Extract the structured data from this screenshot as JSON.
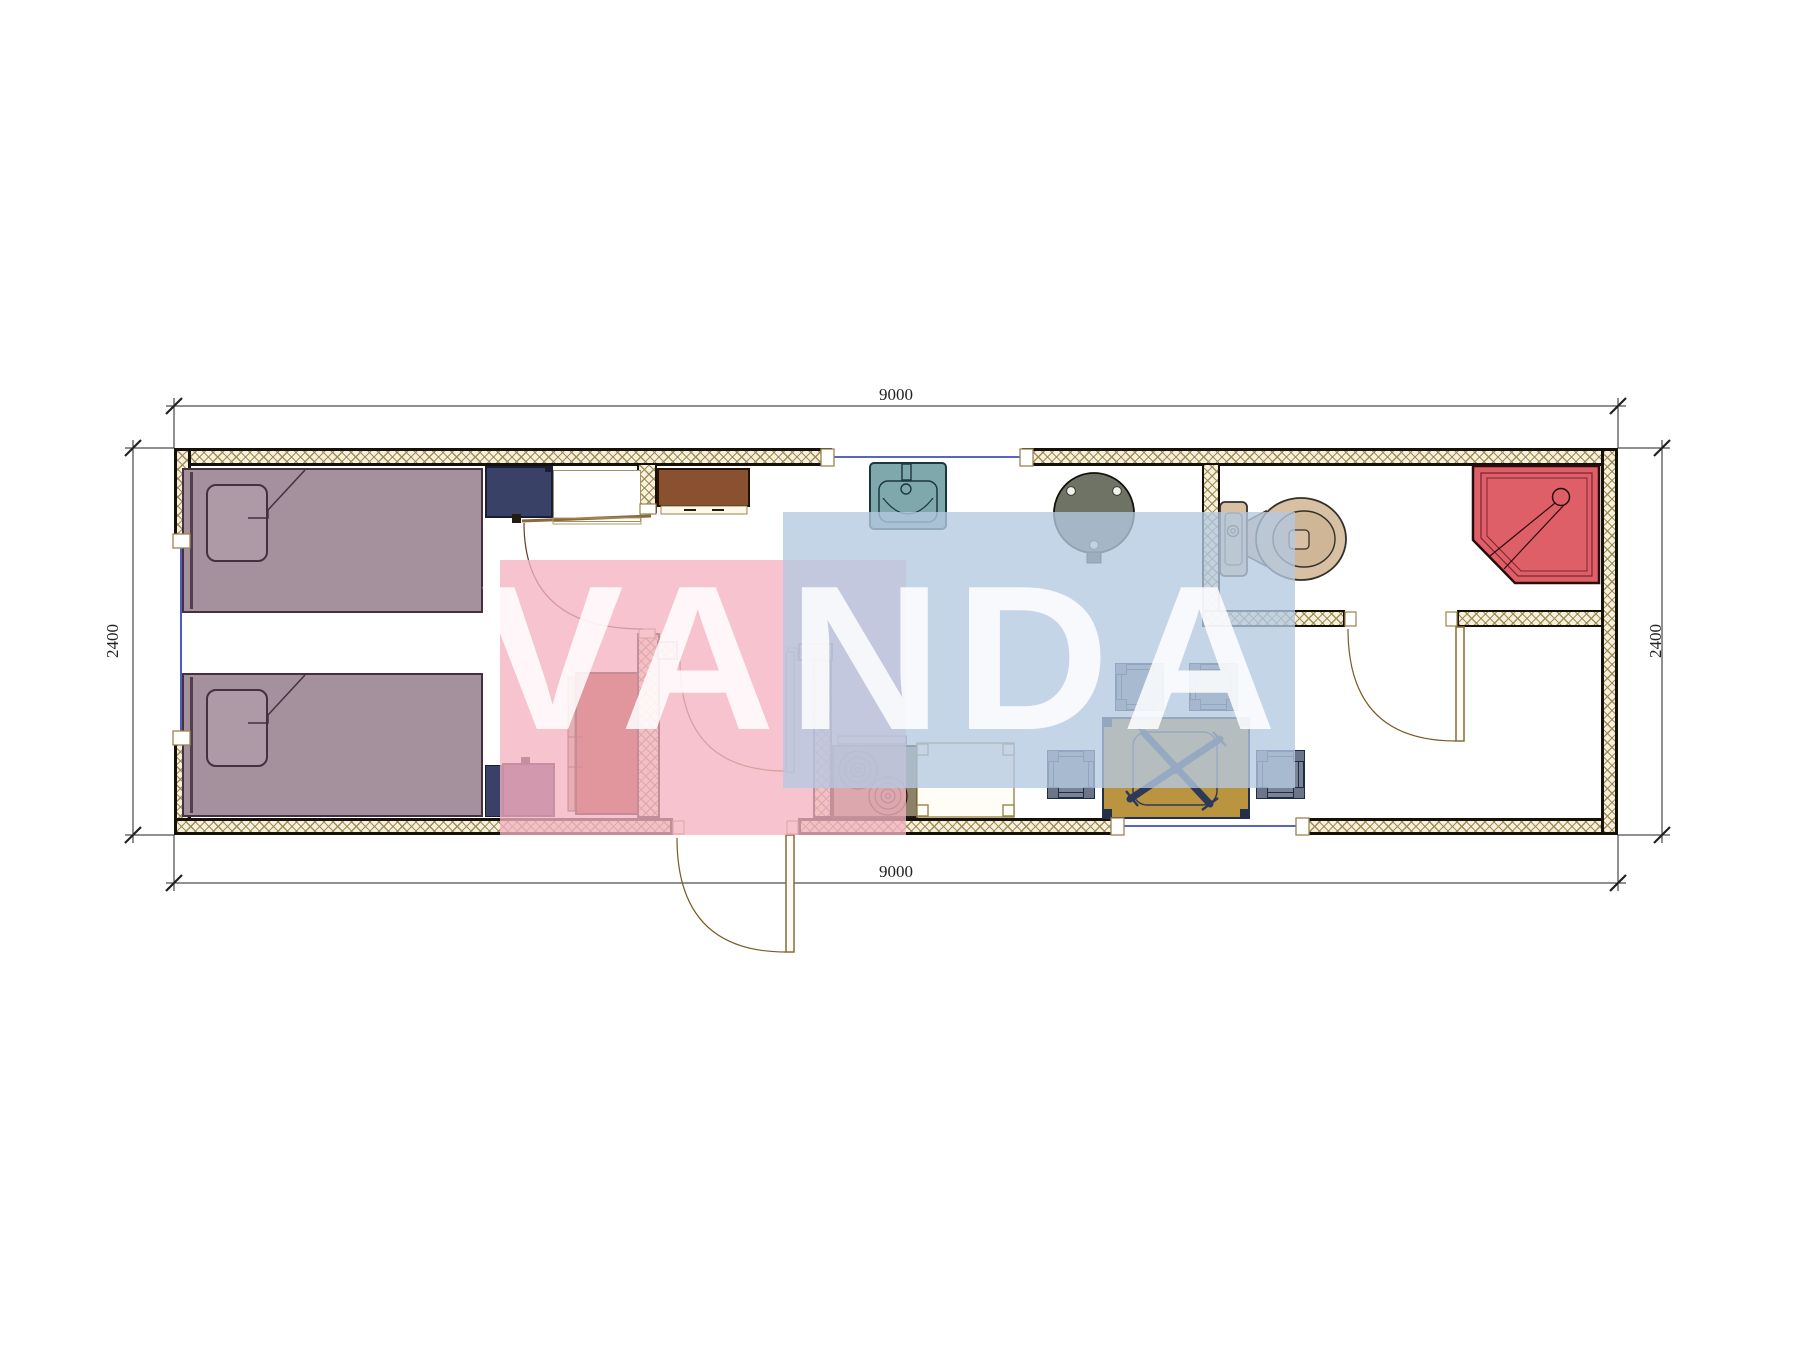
{
  "drawing": {
    "type": "architectural-floor-plan",
    "unit_module": "container cabin 9000 x 2400 mm",
    "dimensions": {
      "top": "9000",
      "bottom": "9000",
      "left": "2400",
      "right": "2400"
    },
    "watermark": {
      "text": "VANDA",
      "pink_color": "#f3b2c1",
      "blue_color": "#b5c9e2"
    },
    "colors": {
      "wall_hatch_bg": "#f7f0dd",
      "wall_hatch_line": "#9b894f",
      "wall_edge": "#15100a",
      "bed": "#a5909d",
      "nightstand_navy": "#3a4166",
      "nightstand_plum": "#5c3c63",
      "wardrobe_red": "#9e3222",
      "cabinet_brown": "#8a5130",
      "stove": "#8d8168",
      "sink_teal": "#7fa8ad",
      "round_table": "#6e7365",
      "dining_table": "#bb9440",
      "stool": "#7b8494",
      "toilet": "#d7c0a3",
      "shower": "#df5f68",
      "window_glazing": "#2233aa",
      "dimension_line": "#222222"
    },
    "rooms": [
      "bedroom with two single beds",
      "entry hall",
      "kitchen-living room",
      "bathroom"
    ],
    "furniture": [
      "single-bed",
      "single-bed",
      "pillow",
      "pillow",
      "nightstand",
      "nightstand",
      "wardrobe",
      "closet-outline",
      "upper-cabinet",
      "stove-2-burners",
      "kitchen-counter",
      "kitchen-sink",
      "round-pedestal-table",
      "dining-table",
      "stool",
      "stool",
      "stool",
      "stool",
      "toilet",
      "corner-shower"
    ],
    "openings": [
      "entrance-door",
      "bedroom-door",
      "hall-door",
      "bathroom-door",
      "window-left",
      "window-top",
      "window-bottom"
    ]
  }
}
